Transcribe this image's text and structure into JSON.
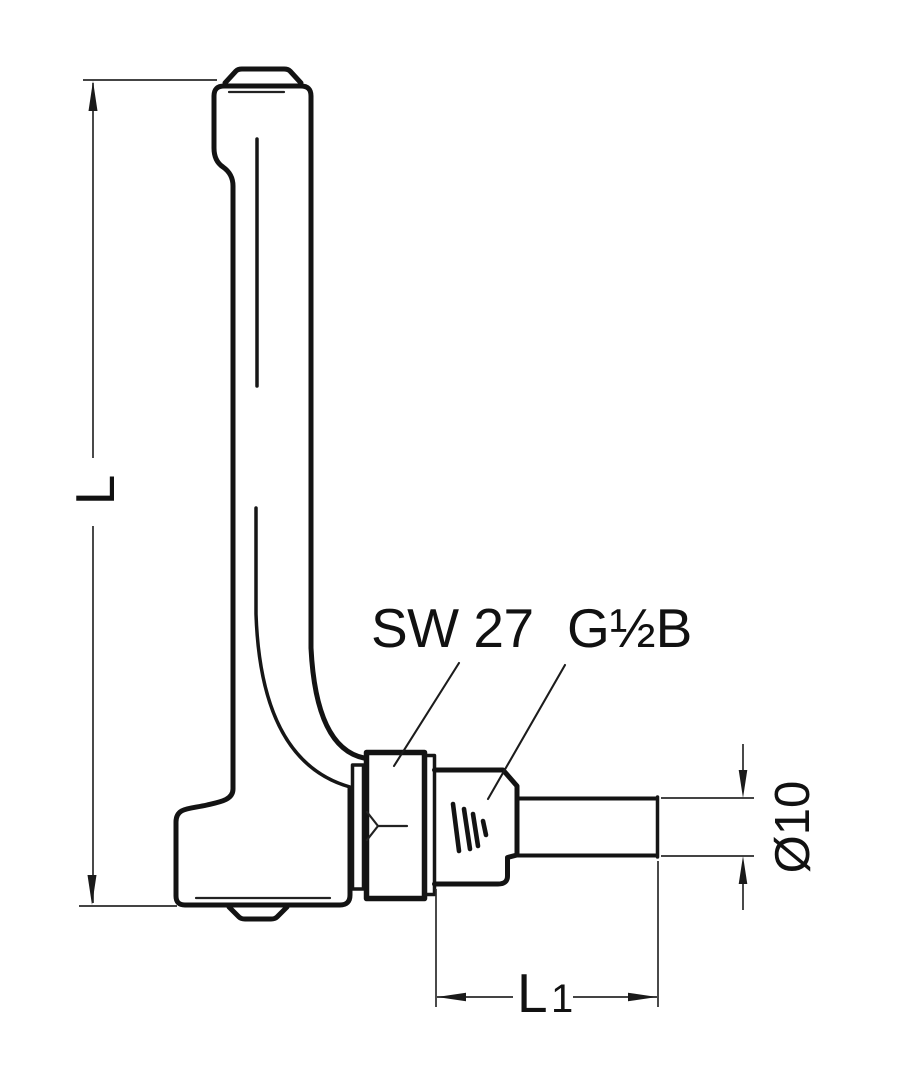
{
  "labels": {
    "overall_length": "L",
    "wrench_size": "SW 27",
    "thread_size": "G½B",
    "stem_diameter": "Ø10",
    "insertion_length_main": "L",
    "insertion_length_sub": "1"
  },
  "colors": {
    "line": "#131313",
    "background": "#ffffff"
  }
}
